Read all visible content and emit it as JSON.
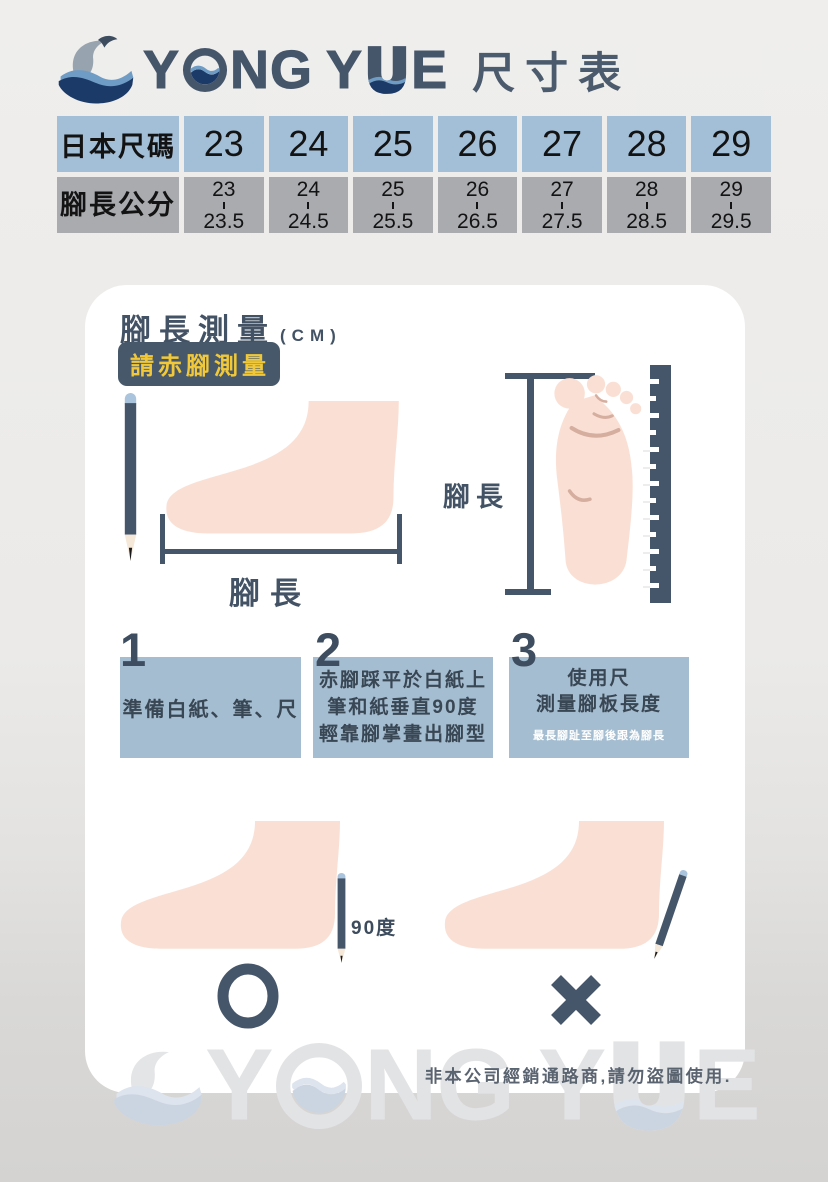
{
  "brand": {
    "name": "YONG YUE",
    "parts": {
      "p1": "Y",
      "p2": "NG",
      "p3": "Y",
      "p4": "E"
    },
    "page_title": "尺寸表"
  },
  "size_table": {
    "row1_label": "日本尺碼",
    "row2_label": "腳長公分",
    "sizes": [
      "23",
      "24",
      "25",
      "26",
      "27",
      "28",
      "29"
    ],
    "ranges": [
      {
        "from": "23",
        "to": "23.5"
      },
      {
        "from": "24",
        "to": "24.5"
      },
      {
        "from": "25",
        "to": "25.5"
      },
      {
        "from": "26",
        "to": "26.5"
      },
      {
        "from": "27",
        "to": "27.5"
      },
      {
        "from": "28",
        "to": "28.5"
      },
      {
        "from": "29",
        "to": "29.5"
      }
    ]
  },
  "card": {
    "heading": "腳長測量",
    "heading_unit": "(CM)",
    "badge": "請赤腳測量",
    "measure_label_bottom": "腳長",
    "measure_label_side": "腳長",
    "steps": [
      {
        "num": "1",
        "line1": "準備白紙、筆、尺"
      },
      {
        "num": "2",
        "line1": "赤腳踩平於白紙上",
        "line2": "筆和紙垂直90度",
        "line3": "輕靠腳掌畫出腳型"
      },
      {
        "num": "3",
        "line1": "使用尺",
        "line2": "測量腳板長度",
        "note": "最長腳趾至腳後跟為腳長"
      }
    ],
    "angle_label": "90度"
  },
  "footer": {
    "disclaimer": "非本公司經銷通路商,請勿盜圖使用."
  },
  "colors": {
    "slate": "#46566a",
    "navy": "#1c3a68",
    "steel_blue": "#6f9cc5",
    "pencil_cap_blue": "#a9c4dc",
    "skin": "#fae0d4",
    "cell_blue": "#a3bfd7",
    "cell_gray": "#a9abaf",
    "step_box_blue": "#a4bdd0",
    "badge_yellow": "#f0c839",
    "watermark_gray": "#e2e3e5"
  }
}
